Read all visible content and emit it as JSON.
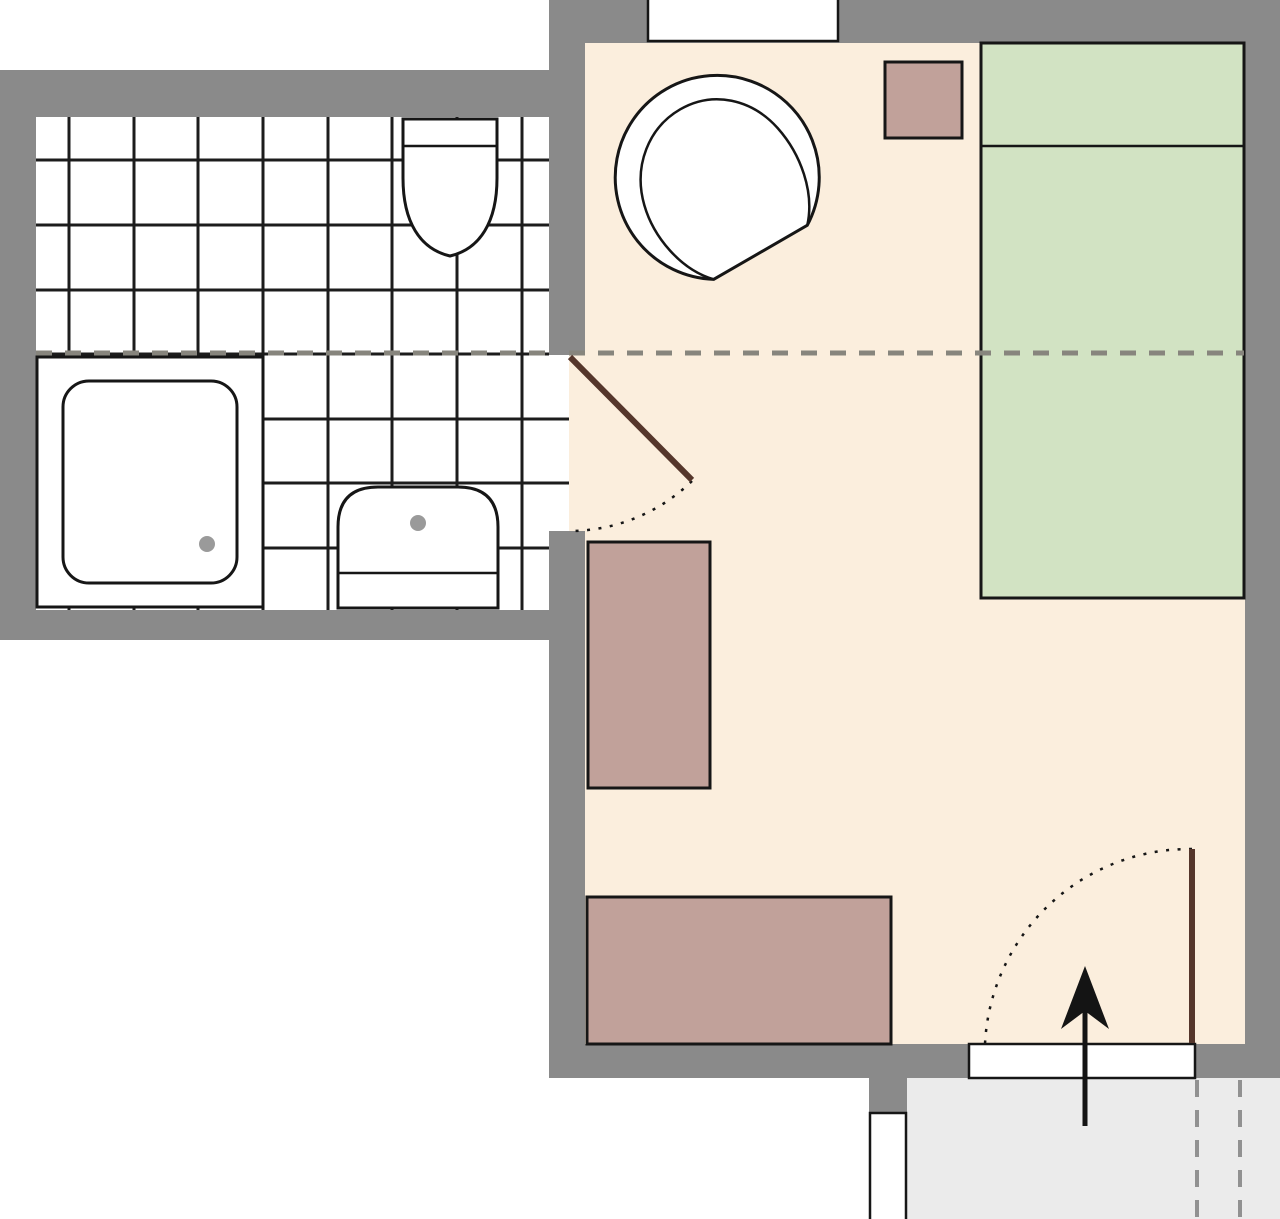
{
  "diagram": {
    "type": "floor-plan",
    "title": "studio apartment floor plan",
    "rooms": [
      "bathroom",
      "main-room",
      "corridor"
    ],
    "elements": [
      "bathroom-tile-floor",
      "shower",
      "shower-tray",
      "shower-drain",
      "sink",
      "sink-faucet",
      "toilet",
      "toilet-tank",
      "interior-door-leaf",
      "interior-door-swing",
      "main-room-floor",
      "armchair",
      "bed",
      "bed-pillow-line",
      "nightstand",
      "wardrobe",
      "desk",
      "section-line",
      "top-window",
      "bottom-window",
      "entry-threshold",
      "entry-door-leaf",
      "entry-door-swing",
      "entry-arrow",
      "corridor-floor",
      "corridor-boundary-markings"
    ]
  },
  "colors": {
    "outside": "#ffffff",
    "wall": "#8a8a8a",
    "outline": "#161616",
    "tile_line": "#1c1c1c",
    "bathroom_floor": "#ffffff",
    "room_floor": "#fbeedd",
    "corridor_floor": "#ebebeb",
    "window_fill": "#ffffff",
    "bed_fill": "#d2e3c3",
    "furniture_fill": "#c1a19a",
    "fixture_fill": "#ffffff",
    "door_leaf": "#55362b",
    "section_dash": "#87857d",
    "corridor_dash": "#919191",
    "drain": "#9a9a9a",
    "arrow": "#141414"
  }
}
